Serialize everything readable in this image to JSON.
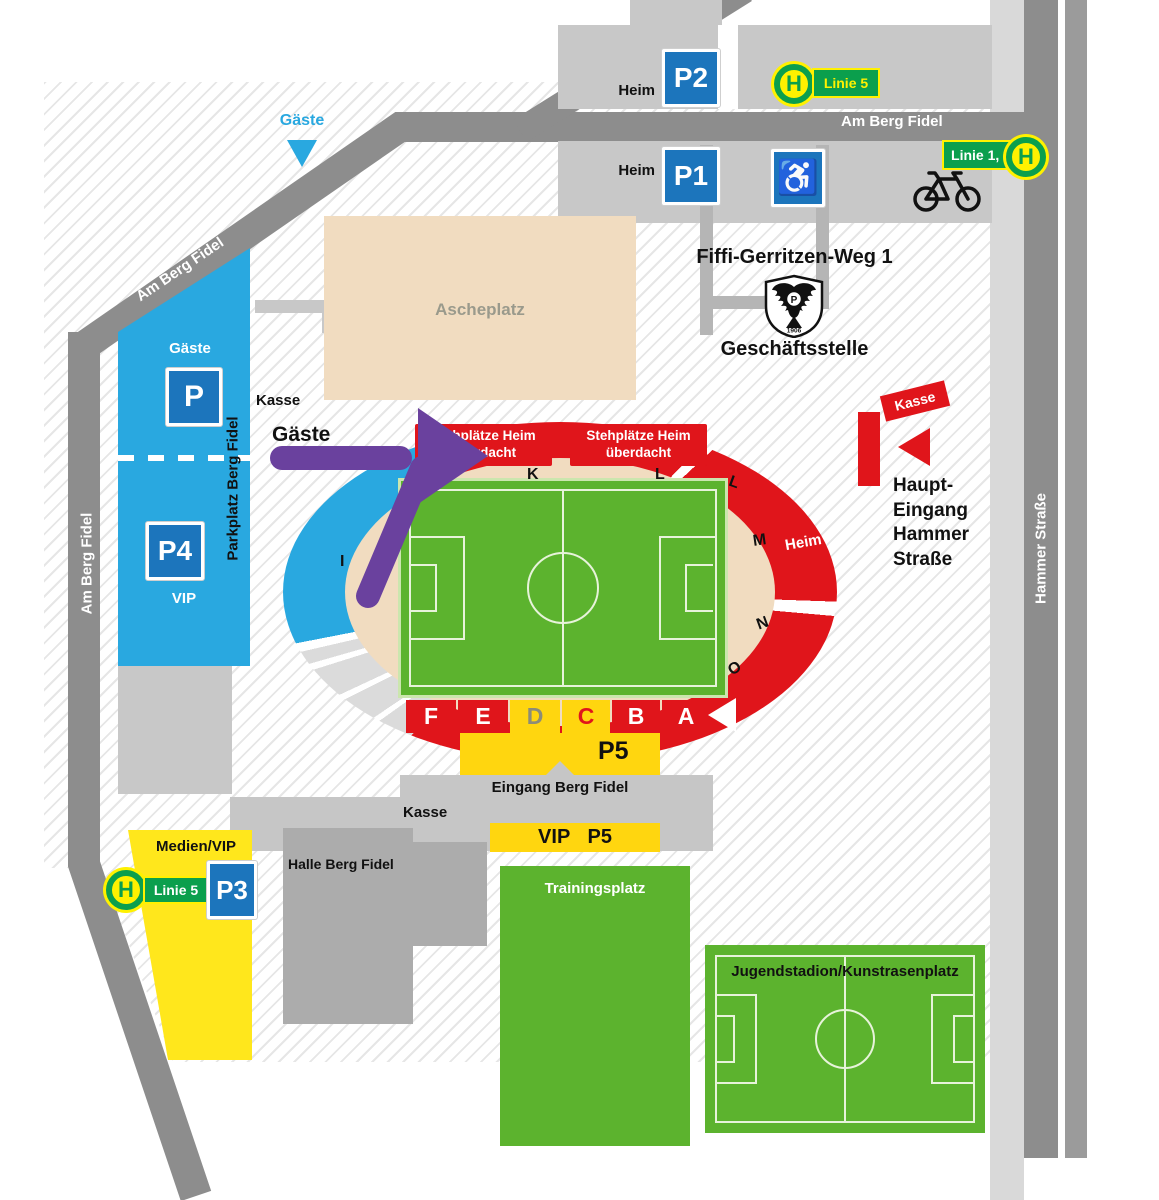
{
  "colors": {
    "road_gray": "#8D8D8D",
    "panel_gray": "#C8C8C8",
    "building_gray": "#ACACAC",
    "parking_blue": "#29A8E0",
    "sign_blue": "#1C75BC",
    "stand_red": "#E0151B",
    "stand_yellow": "#FFD60F",
    "p3_yellow": "#FFE71C",
    "field_green": "#5CB32E",
    "transit_green": "#0B9F4D",
    "transit_yellow": "#FFF100",
    "route_purple": "#6A419E",
    "infield_beige": "#F1DCC0"
  },
  "streets": {
    "top": "Am Berg Fidel",
    "diagonal": "Am Berg Fidel",
    "left": "Am Berg Fidel",
    "right": "Hammer Straße"
  },
  "transit": {
    "h": "H",
    "line5_top": "Linie 5",
    "line1_9": "Linie 1, 9",
    "line5_sw": "Linie 5"
  },
  "parking": {
    "heim_top": "Heim",
    "p2": "P2",
    "heim_mid": "Heim",
    "p1": "P1",
    "wheelchair_glyph": "♿",
    "guest_label": "Gäste",
    "p": "P",
    "p4": "P4",
    "vip": "VIP",
    "lot_street": "Parkplatz Berg Fidel",
    "p3": "P3",
    "medien_vip": "Medien/VIP",
    "p5": "P5",
    "vip_p5": "VIP P5"
  },
  "route": {
    "guest_top": "Gäste",
    "guest_entry": "Gäste"
  },
  "kasse": {
    "west": "Kasse",
    "south": "Kasse",
    "east": "Kasse"
  },
  "stadium": {
    "stand_roofed": "Stehplätze Heim\nüberdacht",
    "heim": "Heim",
    "sections": {
      "a": "A",
      "b": "B",
      "c": "C",
      "d": "D",
      "e": "E",
      "f": "F",
      "i": "I",
      "k": "K",
      "l": "L",
      "l2": "L",
      "m": "M",
      "n": "N",
      "o": "O"
    }
  },
  "areas": {
    "ascheplatz": "Ascheplatz",
    "trainingsplatz": "Trainingsplatz",
    "jugendstadion": "Jugendstadion/Kunstrasenplatz",
    "halle": "Halle Berg Fidel",
    "eingang_sued": "Eingang Berg Fidel"
  },
  "address": {
    "street": "Fiffi-Gerritzen-Weg 1",
    "office": "Geschäftsstelle",
    "crest_initial": "P",
    "crest_year": "1906"
  },
  "entrance_east": {
    "lines": [
      "Haupt-",
      "Eingang",
      "Hammer",
      "Straße"
    ]
  }
}
